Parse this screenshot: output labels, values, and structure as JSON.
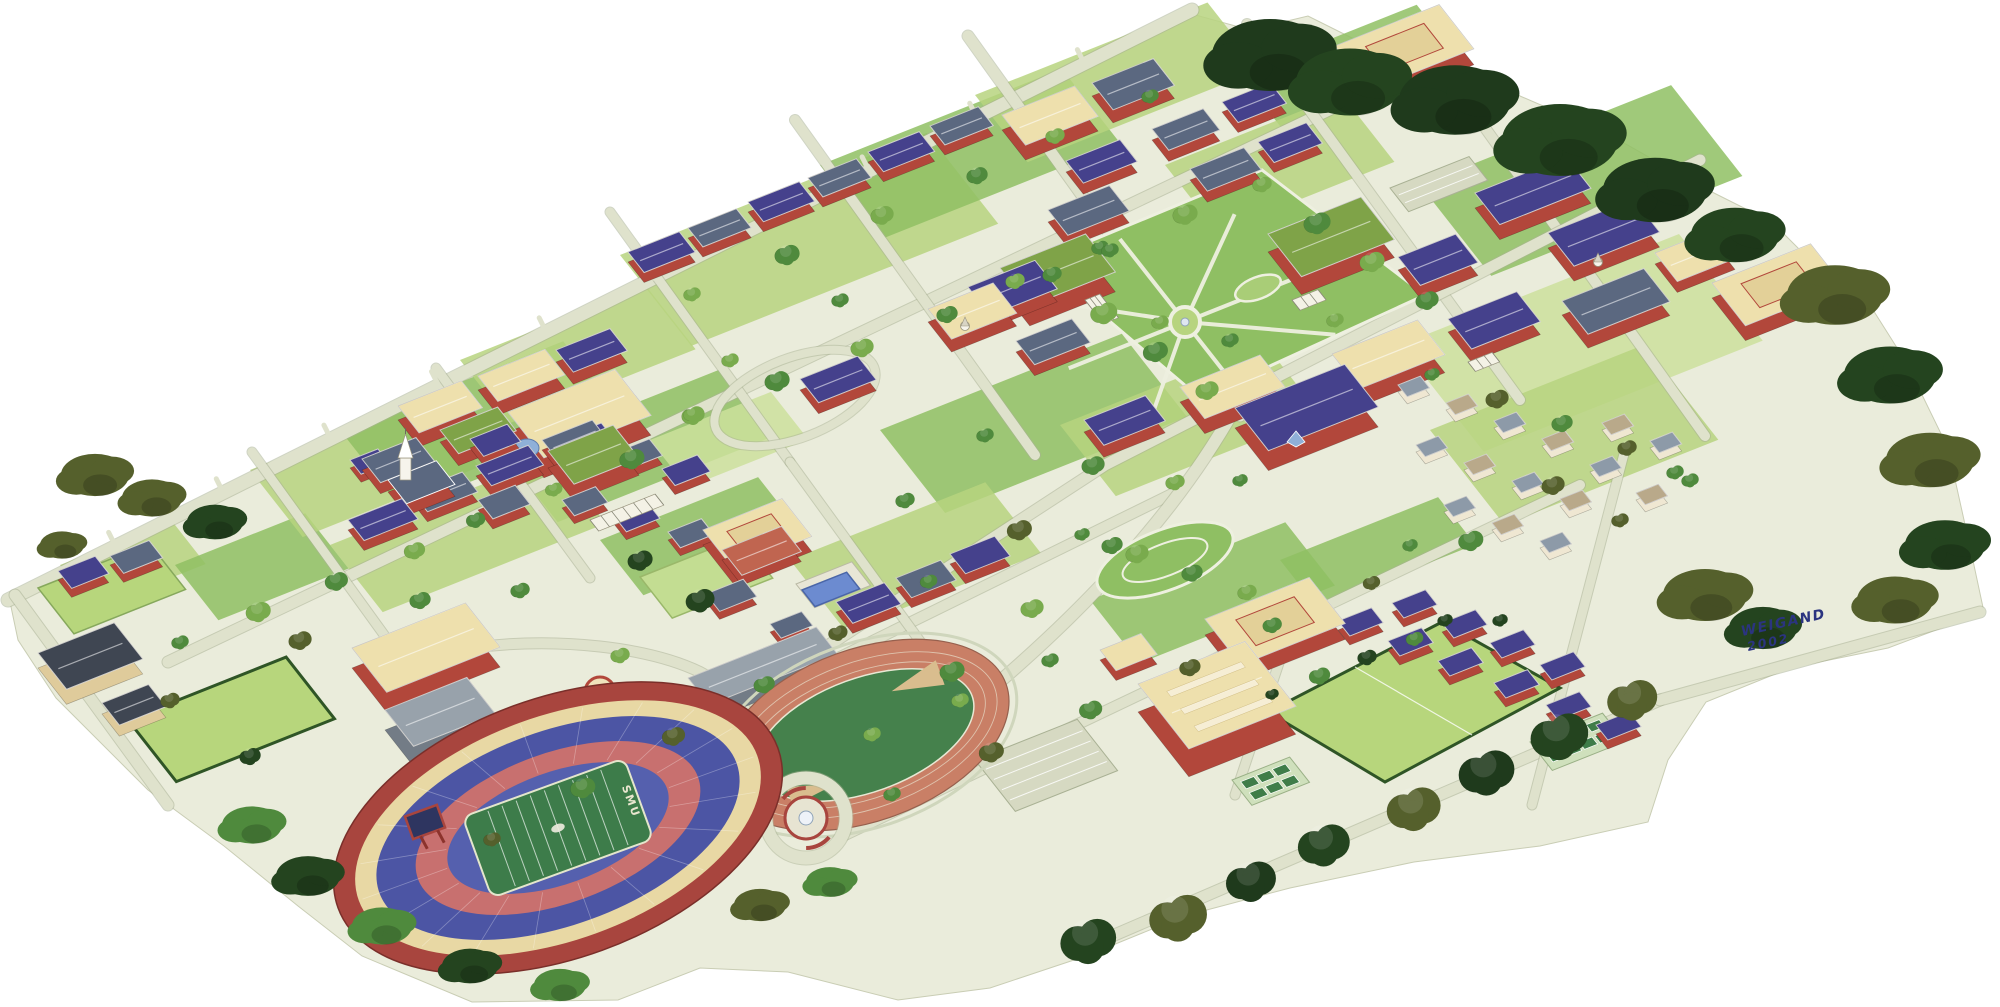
{
  "meta": {
    "title": "Illustrated aerial watercolor map of the SMU campus",
    "style": "hand-drawn watercolor bird's-eye perspective, white paper background"
  },
  "signature": {
    "artist": "WEIGAND",
    "year": "2002",
    "ink_color": "#2b3480"
  },
  "stadium": {
    "field_text": "SMU",
    "field_text_color": "#e9e6cf"
  },
  "palette": {
    "paper": "#ffffff",
    "ground": "#eaecdb",
    "road": "#dfe2cc",
    "road_edge": "#a9b194",
    "path": "#eef0e0",
    "lawn": "#8fbf63",
    "lawn_light": "#b7d47f",
    "lawn_pale": "#cde09c",
    "hedge": "#2f5526",
    "wall_brick": "#b2473b",
    "wall_brick_dark": "#8c332c",
    "wall_tan": "#dfcb9b",
    "wall_gray": "#737c86",
    "wall_offwhite": "#efe7d2",
    "roof_navy": "#45418c",
    "roof_slate": "#5b6880",
    "roof_darkslate": "#3f4652",
    "roof_tan": "#eee0ad",
    "roof_green": "#7fa348",
    "roof_gray": "#98a2ab",
    "roof_terra": "#c06550",
    "roof_house1": "#b9a98a",
    "roof_house2": "#8d9aa8",
    "tree_light": "#79ab4d",
    "tree_mid": "#4f8a3d",
    "tree_dark": "#24441f",
    "tree_olive": "#55602c",
    "tree_forest": "#1f3a1c",
    "track": "#c97f66",
    "track_edge": "#96604e",
    "infield": "#45814c",
    "field_light": "#b7d67c",
    "stadium_wall": "#a8453e",
    "concourse": "#e8d8a4",
    "stadium_blue": "#4c55a4",
    "stadium_blue2": "#5560ae",
    "stadium_red": "#c8706f",
    "field_green": "#3d7c4a",
    "pool": "#6c8bd0",
    "pool_dark": "#4a66a8",
    "tennis": "#3f7d49",
    "tennis_apron": "#cfe0bc",
    "dome": "#9db837",
    "glass": "#8fb0d8",
    "court_tan": "#e3d098",
    "ink": "#2b3480"
  }
}
